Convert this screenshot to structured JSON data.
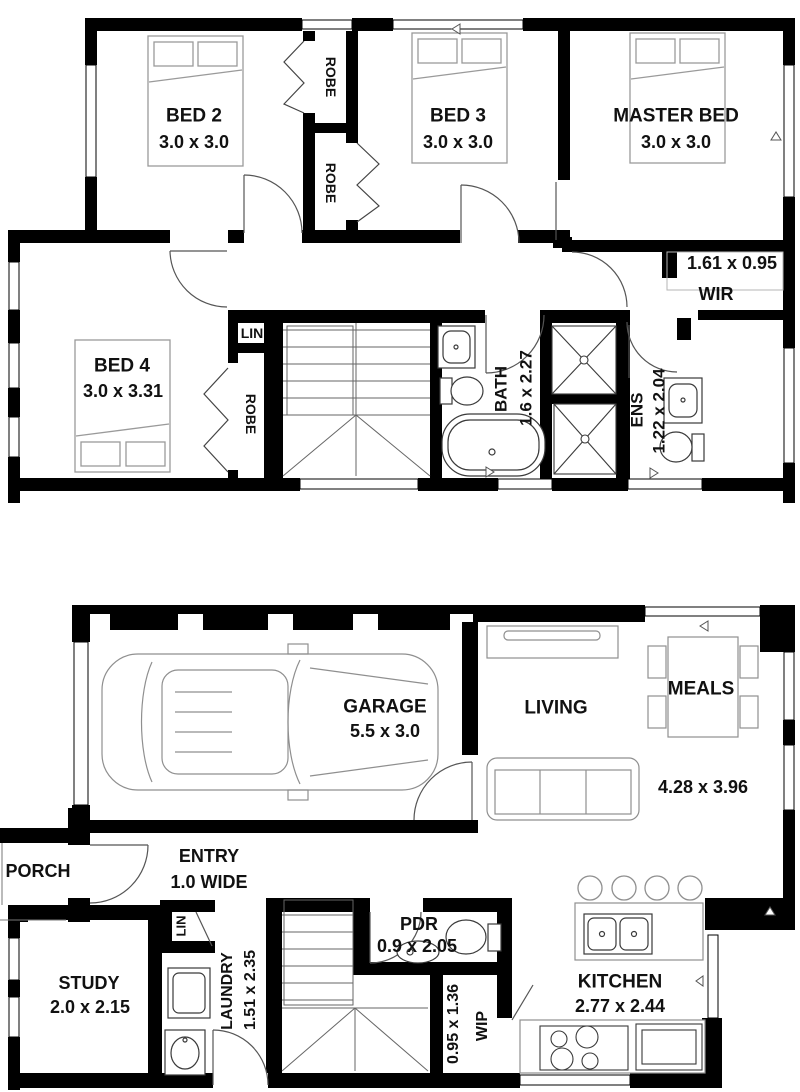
{
  "upper_floor": {
    "bed2": {
      "label": "BED 2",
      "dims": "3.0 x 3.0"
    },
    "bed3": {
      "label": "BED 3",
      "dims": "3.0 x 3.0"
    },
    "master_bed": {
      "label": "MASTER BED",
      "dims": "3.0 x 3.0"
    },
    "bed4": {
      "label": "BED 4",
      "dims": "3.0 x 3.31"
    },
    "robe_top": {
      "label": "ROBE"
    },
    "robe_mid": {
      "label": "ROBE"
    },
    "robe_bed4": {
      "label": "ROBE"
    },
    "lin": {
      "label": "LIN"
    },
    "wir": {
      "label": "WIR",
      "dims": "1.61 x 0.95"
    },
    "bath": {
      "label": "BATH",
      "dims": "1.6 x 2.27"
    },
    "ens": {
      "label": "ENS",
      "dims": "1.22 x 2.04"
    }
  },
  "ground_floor": {
    "garage": {
      "label": "GARAGE",
      "dims": "5.5 x 3.0"
    },
    "living": {
      "label": "LIVING"
    },
    "meals": {
      "label": "MEALS"
    },
    "living_meals_dims": "4.28 x 3.96",
    "porch": {
      "label": "PORCH"
    },
    "entry": {
      "label": "ENTRY",
      "dims": "1.0 WIDE"
    },
    "study": {
      "label": "STUDY",
      "dims": "2.0 x 2.15"
    },
    "lin": {
      "label": "LIN"
    },
    "laundry": {
      "label": "LAUNDRY",
      "dims": "1.51 x 2.35"
    },
    "pdr": {
      "label": "PDR",
      "dims": "0.9 x 2.05"
    },
    "wip": {
      "label": "WIP",
      "dims": "0.95 x 1.36"
    },
    "kitchen": {
      "label": "KITCHEN",
      "dims": "2.77 x 2.44"
    }
  },
  "colors": {
    "wall": "#000000",
    "background": "#ffffff",
    "furniture_outline": "#8f8f8f",
    "fixture_outline": "#3a3a3a",
    "text": "#111111"
  }
}
